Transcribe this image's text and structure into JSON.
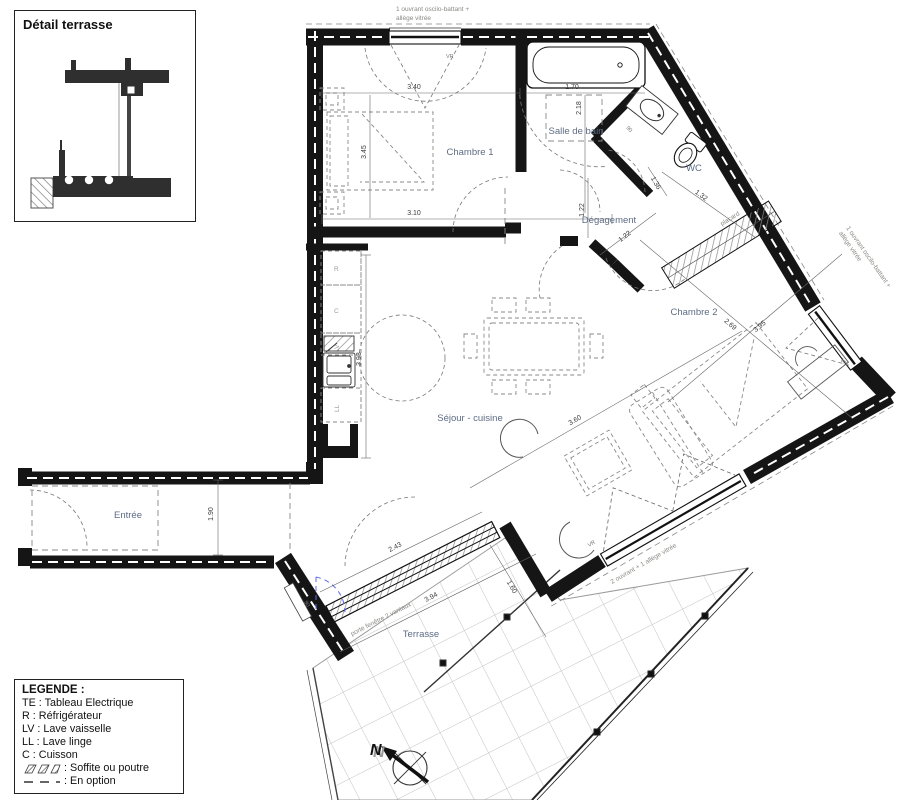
{
  "detail_inset": {
    "title": "Détail terrasse"
  },
  "legend": {
    "title": "LEGENDE :",
    "items": [
      "TE : Tableau Electrique",
      "R : Réfrigérateur",
      "LV : Lave vaisselle",
      "LL : Lave linge",
      "C : Cuisson"
    ],
    "soffite_label": ": Soffite ou poutre",
    "option_label": ": En option"
  },
  "rooms": {
    "chambre1": "Chambre 1",
    "salle_de_bain": "Salle de bain",
    "wc": "WC",
    "degagement": "Dégagement",
    "chambre2": "Chambre 2",
    "sejour": "Séjour - cuisine",
    "entree": "Entrée",
    "terrasse": "Terrasse"
  },
  "annotations": {
    "window_top_line1": "1 ouvrant oscilo-battant +",
    "window_top_line2": "allège vitrée",
    "window_right_line1": "1 ouvrant oscilo-battant +",
    "window_right_line2": "allège vitrée",
    "window_sejour": "2 ouvrant + 1 allège vitrée",
    "terrace_door": "porte fenêtre 2 vantaux",
    "placard": "placard",
    "vr": "VR"
  },
  "appliances": {
    "r": "R",
    "c": "C",
    "lv": "LV",
    "ll": "LL"
  },
  "dimensions": {
    "ch1_width": "3.40",
    "ch1_height": "3.45",
    "ch1_bottom": "3.10",
    "bath_width": "1.70",
    "bath_height": "2.18",
    "deg_v": "1.22",
    "deg_d": "1.22",
    "wc_a": "1.36",
    "wc_b": "1.32",
    "wc_door": "90",
    "ch2_a": "2.69",
    "ch2_b": "3.95",
    "kitchen_h": "3.93",
    "sejour_d": "3.60",
    "entree_h": "1.90",
    "terrace_len": "3.94",
    "terrace_door_w": "2.43",
    "terrace_w": "1.60",
    "option_door": "90"
  },
  "compass": {
    "label": "N"
  },
  "colors": {
    "wall": "#151515",
    "room_label": "#5d6c84",
    "option_blue": "#5b6bf0"
  }
}
